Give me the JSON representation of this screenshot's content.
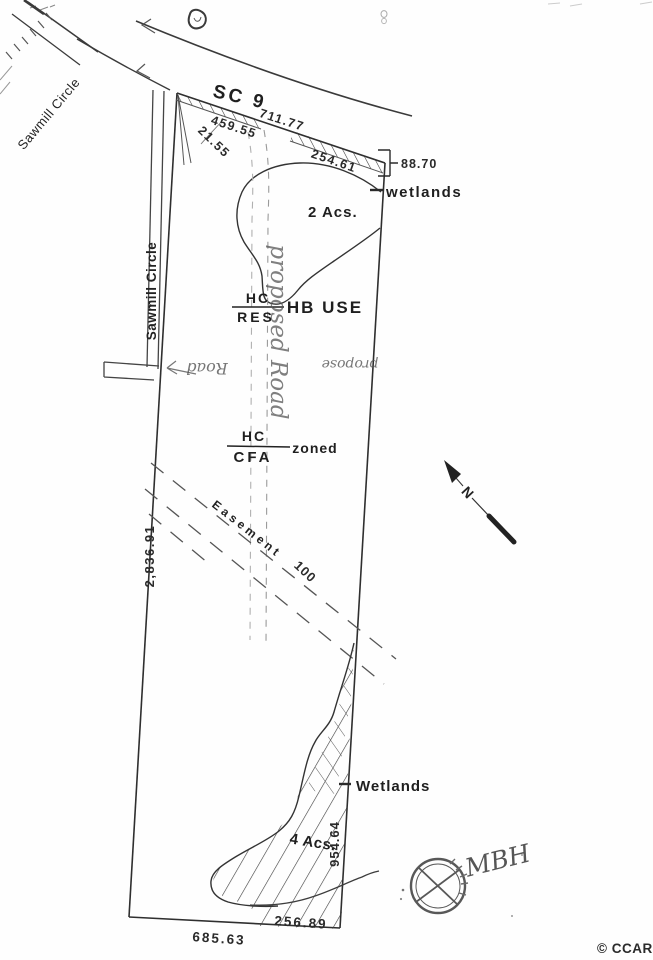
{
  "watermark": {
    "copyright": "© CCAR"
  },
  "roads": {
    "highway": "SC 9",
    "circle_diagonal": "Sawmill Circle",
    "circle_vertical": "Sawmill Circle"
  },
  "boundary_dimensions": {
    "top_total": "711.77",
    "top_segment_a": "459.55",
    "top_segment_b": "21.55",
    "top_segment_c": "254.61",
    "right_top": "88.70",
    "right_bottom": "954.64",
    "left_side": "2,836.91",
    "bottom_left": "685.63",
    "bottom_right": "256.89",
    "easement_width": "100"
  },
  "areas": {
    "wetlands_upper_label": "wetlands",
    "wetlands_upper_acreage": "2 Acs.",
    "wetlands_lower_label": "Wetlands",
    "wetlands_lower_acreage": "4 Acs."
  },
  "zoning": {
    "upper_numerator": "HC",
    "upper_denominator": "RES",
    "upper_note": "HB USE",
    "lower_numerator": "HC",
    "lower_denominator": "CFA",
    "lower_note": "zoned"
  },
  "easement_label": "Easement",
  "north_label": "N",
  "annotations": {
    "proposed_road_vertical": "proposed Road",
    "propose_note": "propose",
    "road_note": "Road",
    "surveyor_initials": "MBH"
  }
}
